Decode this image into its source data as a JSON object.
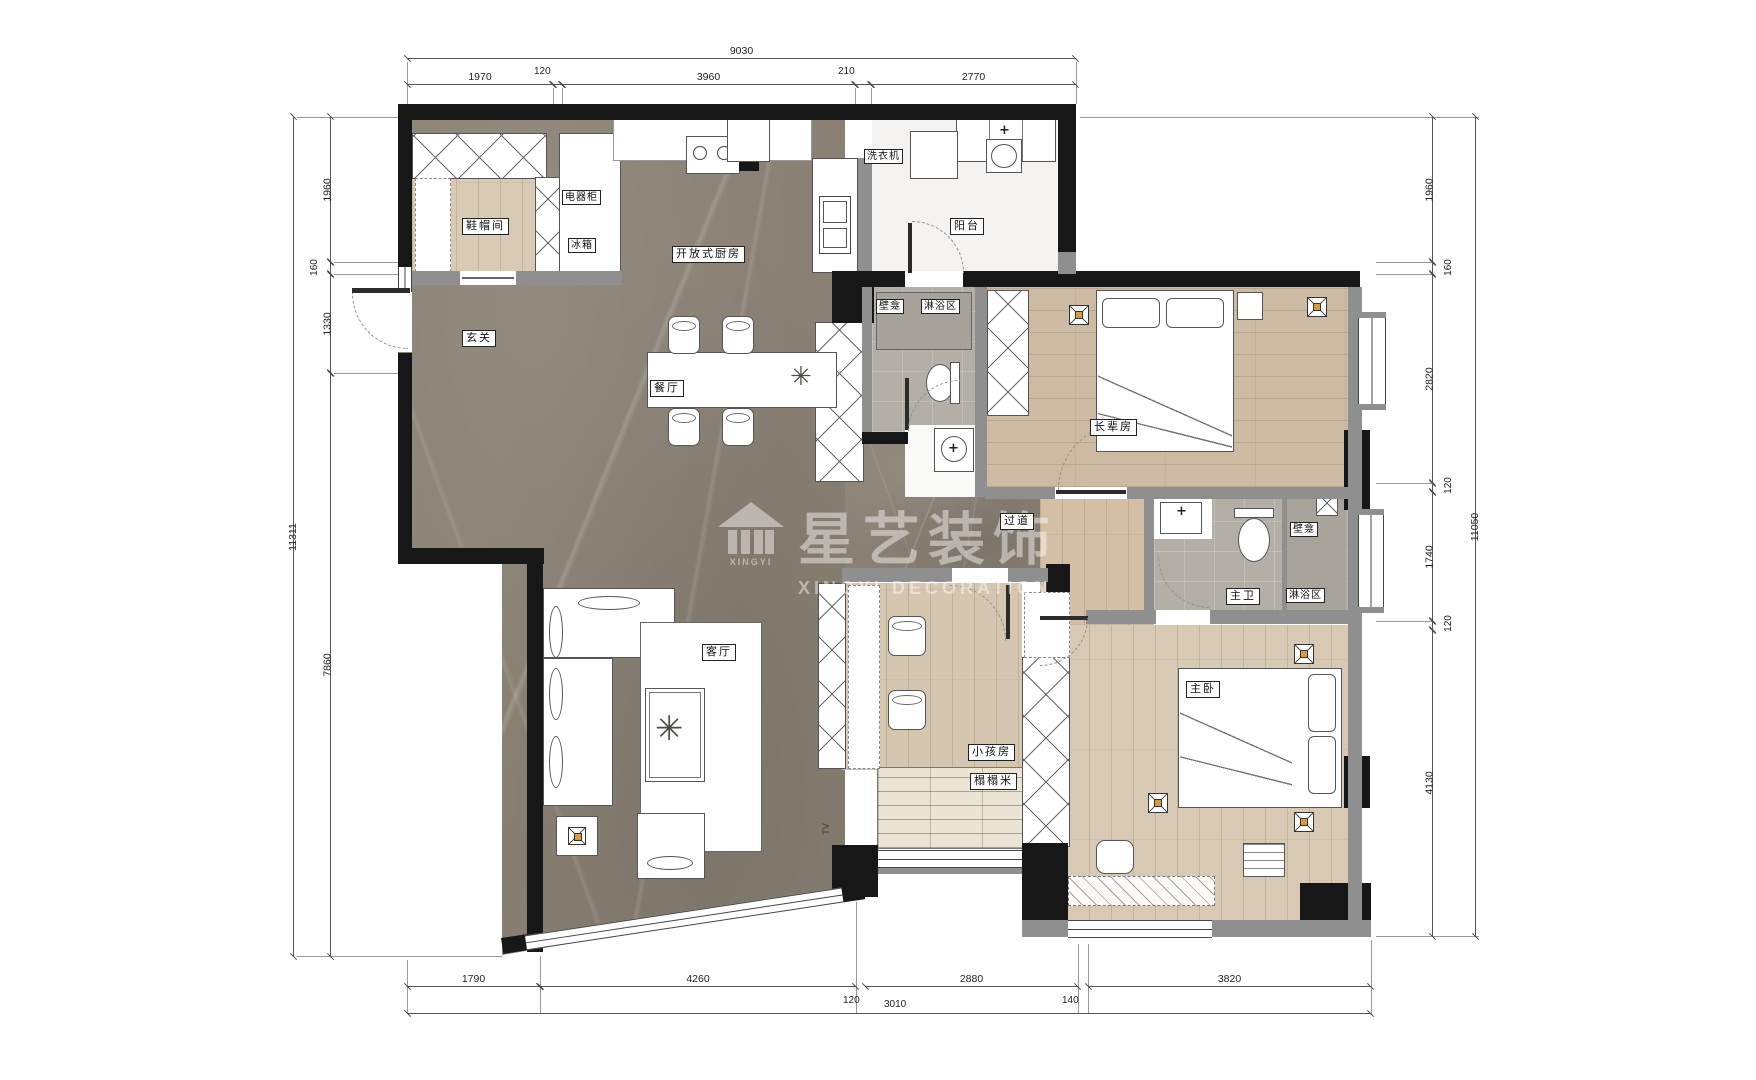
{
  "brand": {
    "name": "星艺装饰",
    "name_en": "XINGYI  DECORATION",
    "logo_caption": "XINGYI"
  },
  "rooms": {
    "entry": "玄关",
    "shoe_room": "鞋帽间",
    "appliance_cabinet": "电器柜",
    "fridge": "冰箱",
    "open_kitchen": "开放式厨房",
    "dining": "餐厅",
    "living": "客厅",
    "balcony": "阳台",
    "washing_machine": "洗衣机",
    "niche": "壁龛",
    "shower_area": "淋浴区",
    "elder_room": "长辈房",
    "corridor": "过道",
    "master_bath": "主卫",
    "kids_room": "小孩房",
    "tatami": "榻榻米",
    "master_bedroom": "主卧",
    "tv": "TV"
  },
  "dimensions": {
    "top": {
      "total": "9030",
      "segments": [
        "1970",
        "120",
        "3960",
        "210",
        "2770"
      ]
    },
    "left": {
      "total": "11311",
      "segments": [
        "1960",
        "160",
        "1330",
        "7860"
      ]
    },
    "right": {
      "total": "11050",
      "segments": [
        "1960",
        "160",
        "2820",
        "120",
        "1740",
        "120",
        "4130"
      ]
    },
    "bottom": {
      "segments": [
        "1790",
        "4260",
        "2880",
        "3820"
      ],
      "sub_segments": [
        "120",
        "3010",
        "140"
      ]
    }
  }
}
